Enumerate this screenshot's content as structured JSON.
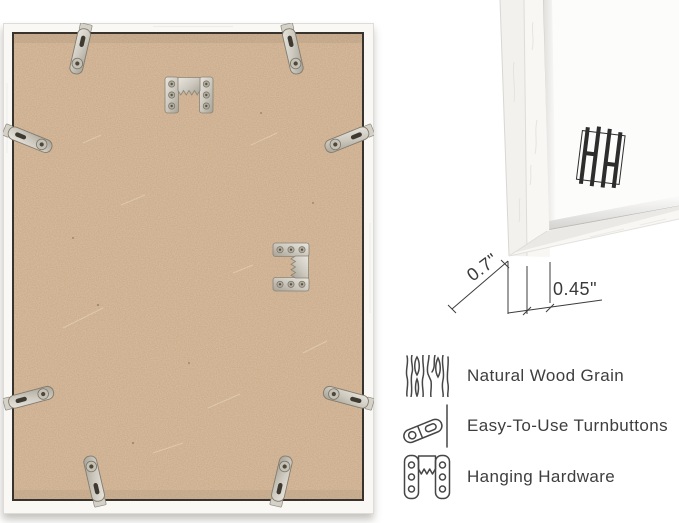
{
  "canvas": {
    "width_px": 679,
    "height_px": 523,
    "background": "#ffffff"
  },
  "frame_back_photo": {
    "board_color": "#c7a685",
    "frame_color": "#f9f8f5",
    "edge_line_color": "#38332c",
    "metal_color": "#cdc9bf",
    "turnbutton_count": 8,
    "sawtooth_hanger_count": 2
  },
  "corner_closeup": {
    "logo_icon": "hh-monogram-logo",
    "depth_label": "0.7\"",
    "face_width_label": "0.45\""
  },
  "features": {
    "text_color": "#3e3e3e",
    "items": [
      {
        "icon": "wood-grain-icon",
        "label": "Natural Wood Grain"
      },
      {
        "icon": "turnbutton-icon",
        "label": "Easy-To-Use Turnbuttons"
      },
      {
        "icon": "hanging-hardware-icon",
        "label": "Hanging Hardware"
      }
    ]
  }
}
